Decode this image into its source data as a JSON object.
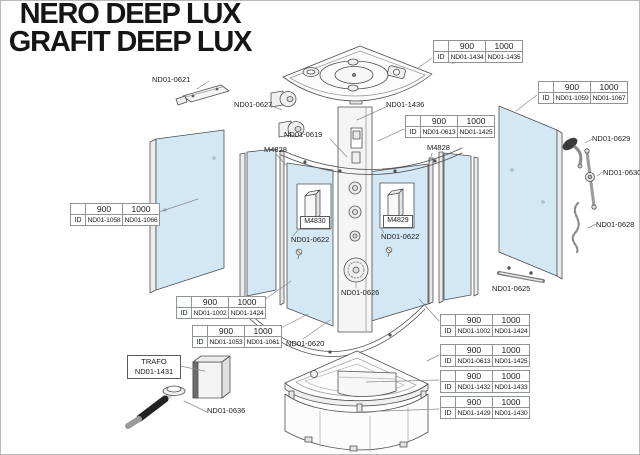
{
  "title": {
    "line1": "NERO DEEP LUX",
    "line2": "GRAFIT DEEP LUX"
  },
  "colors": {
    "glass": "#d3e7f5",
    "diagram_line": "#4f4f4f",
    "text": "#1b1b1b",
    "table_border": "#8f9499"
  },
  "table_header": {
    "blank": "",
    "w900": "900",
    "w1000": "1000",
    "id": "ID"
  },
  "tables": [
    {
      "name": "roof",
      "code_900": "ND01-1434",
      "code_1000": "ND01-1435"
    },
    {
      "name": "right-back-panel",
      "code_900": "ND01-1059",
      "code_1000": "ND01-1067"
    },
    {
      "name": "door-glass-upper",
      "code_900": "ND01-0613",
      "code_1000": "ND01-1425"
    },
    {
      "name": "left-back-panel",
      "code_900": "ND01-1058",
      "code_1000": "ND01-1066"
    },
    {
      "name": "door-left",
      "code_900": "ND01-1002",
      "code_1000": "ND01-1424"
    },
    {
      "name": "fixed-glass",
      "code_900": "ND01-1053",
      "code_1000": "ND01-1061"
    },
    {
      "name": "door-right",
      "code_900": "ND01-1002",
      "code_1000": "ND01-1424"
    },
    {
      "name": "door-glass-lower",
      "code_900": "ND01-0613",
      "code_1000": "ND01-1425"
    },
    {
      "name": "shower-tray",
      "code_900": "ND01-1432",
      "code_1000": "ND01-1433"
    },
    {
      "name": "tray-front-panel",
      "code_900": "ND01-1429",
      "code_1000": "ND01-1430"
    }
  ],
  "part_labels": [
    {
      "name": "top-bracket",
      "text": "ND01-0621"
    },
    {
      "name": "door-rollers",
      "text": "ND01-0627"
    },
    {
      "name": "control-column",
      "text": "ND01-1436"
    },
    {
      "name": "top-curved-rail",
      "text": "ND01-0619"
    },
    {
      "name": "magnet-strip-left",
      "text": "M4828"
    },
    {
      "name": "magnet-strip-right",
      "text": "M4828"
    },
    {
      "name": "door-knob-left",
      "text": "ND01-0622"
    },
    {
      "name": "door-knob-right",
      "text": "ND01-0622"
    },
    {
      "name": "speaker-unit",
      "text": "ND01-0626"
    },
    {
      "name": "bottom-curved-rail",
      "text": "ND01-0620"
    },
    {
      "name": "towel-bar",
      "text": "ND01-0625"
    },
    {
      "name": "hand-shower",
      "text": "ND01-0629"
    },
    {
      "name": "shower-rail",
      "text": "ND01-0630"
    },
    {
      "name": "shower-hose",
      "text": "ND01-0628"
    },
    {
      "name": "drain-hose",
      "text": "ND01-0636"
    }
  ],
  "boxed_labels": [
    {
      "name": "magnet-profile-left",
      "text": "M4830"
    },
    {
      "name": "magnet-profile-right",
      "text": "M4829"
    }
  ],
  "trafo": {
    "line1": "TRAFO",
    "line2": "ND01-1431"
  }
}
